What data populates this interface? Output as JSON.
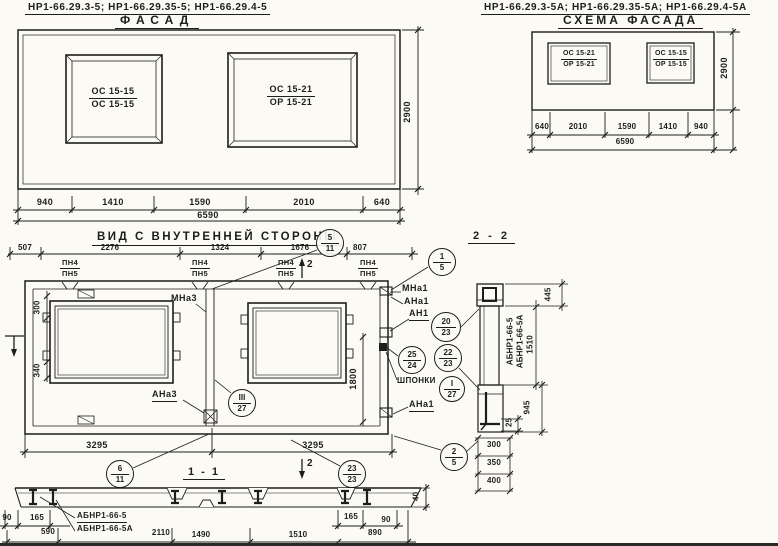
{
  "colors": {
    "paper": "#fbfaf5",
    "ink": "#1d1d1b"
  },
  "facade": {
    "header": "НР1-66.29.3-5;  НР1-66.29.35-5;  НР1-66.29.4-5",
    "title": "ФАСАД",
    "window_left": {
      "top": "ОС 15-15",
      "bottom": "ОС 15-15"
    },
    "window_right": {
      "top": "ОС 15-21",
      "bottom": "ОР 15-21"
    },
    "dims": {
      "d1": "940",
      "d2": "1410",
      "d3": "1590",
      "d4": "2010",
      "d5": "640",
      "total": "6590",
      "height": "2900"
    }
  },
  "schema": {
    "header": "НР1-66.29.3-5А;  НР1-66.29.35-5А;  НР1-66.29.4-5А",
    "title": "СХЕМА ФАСАДА",
    "window_left": {
      "top": "ОС 15-21",
      "bottom": "ОР 15-21"
    },
    "window_right": {
      "top": "ОС 15-15",
      "bottom": "ОР 15-15"
    },
    "dims": {
      "d1": "640",
      "d2": "2010",
      "d3": "1590",
      "d4": "1410",
      "d5": "940",
      "total": "6590",
      "height": "2900"
    }
  },
  "inner_view": {
    "title": "ВИД С ВНУТРЕННЕЙ СТОРОНЫ",
    "top_dims": {
      "d1": "507",
      "d2": "2276",
      "d3": "1324",
      "d4": "1676",
      "d5": "807"
    },
    "pn_label": {
      "top": "ПН4",
      "bottom": "ПН5"
    },
    "section_marker_top": "2",
    "section_marker_bottom": "2",
    "labels": {
      "mna3": "МНа3",
      "ana3": "АНа3",
      "mna1": "МНа1",
      "ana1": "АНа1",
      "an1": "АН1",
      "shponki": "ШПОНКИ",
      "ana1_bottom": "АНа1"
    },
    "dims": {
      "v300": "300",
      "v340": "340",
      "v1800": "1800",
      "bottom_left": "3295",
      "bottom_right": "3295"
    },
    "balloons": {
      "b5_11": {
        "top": "5",
        "bottom": "11"
      },
      "b1_5": {
        "top": "1",
        "bottom": "5"
      },
      "b20_23": {
        "top": "20",
        "bottom": "23"
      },
      "b25_24": {
        "top": "25",
        "bottom": "24"
      },
      "b22_23": {
        "top": "22",
        "bottom": "23"
      },
      "bI_27": {
        "top": "I",
        "bottom": "27"
      },
      "bIII_27": {
        "top": "III",
        "bottom": "27"
      },
      "b6_11": {
        "top": "6",
        "bottom": "11"
      },
      "b23_23": {
        "top": "23",
        "bottom": "23"
      },
      "b2_5": {
        "top": "2",
        "bottom": "5"
      }
    }
  },
  "section_1_1": {
    "title": "1 - 1",
    "labels": {
      "mark_a": "АБНР1-66-5",
      "mark_b": "АБНР1-66-5А"
    },
    "dims": {
      "left_90": "90",
      "left_165": "165",
      "d590": "590",
      "d2110": "2110",
      "d1490": "1490",
      "d1510": "1510",
      "d890": "890",
      "right_165": "165",
      "right_90": "90",
      "v40": "40"
    }
  },
  "section_2_2": {
    "title": "2 - 2",
    "rotated_labels": {
      "mark_a": "АБНР1-66-5",
      "mark_b": "АБНР1-66-5А",
      "height": "1510"
    },
    "dims": {
      "d445": "445",
      "d25": "25",
      "d945": "945",
      "s300": "300",
      "s350": "350",
      "s400": "400"
    }
  }
}
